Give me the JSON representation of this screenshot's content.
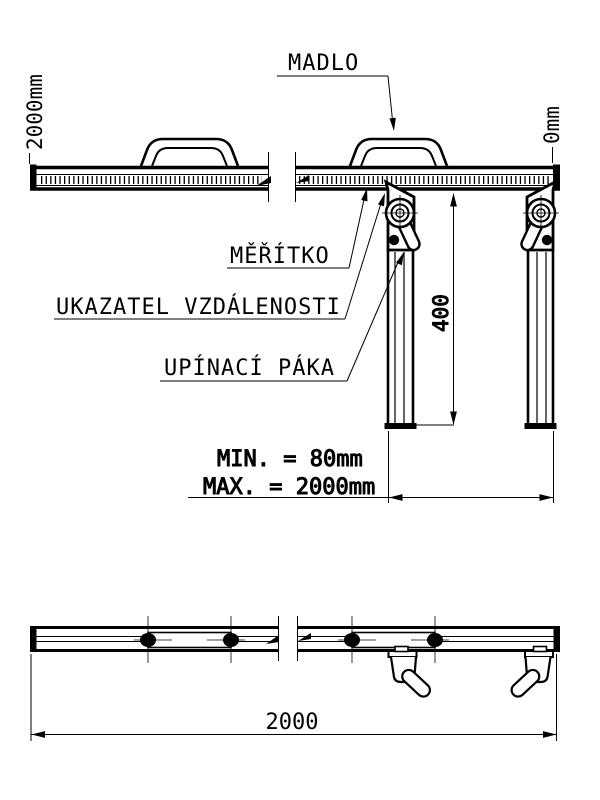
{
  "labels": {
    "madlo": "MADLO",
    "meritko": "MĚŘÍTKO",
    "ukazatel": "UKAZATEL VZDÁLENOSTI",
    "upinaci": "UPÍNACÍ PÁKA"
  },
  "scale": {
    "left_end": "2000mm",
    "right_end": "0mm"
  },
  "dimensions": {
    "min": "MIN. = 80mm",
    "max": "MAX. = 2000mm",
    "leg_height": "400",
    "total_length": "2000"
  },
  "colors": {
    "line": "#000000",
    "background": "#ffffff"
  }
}
